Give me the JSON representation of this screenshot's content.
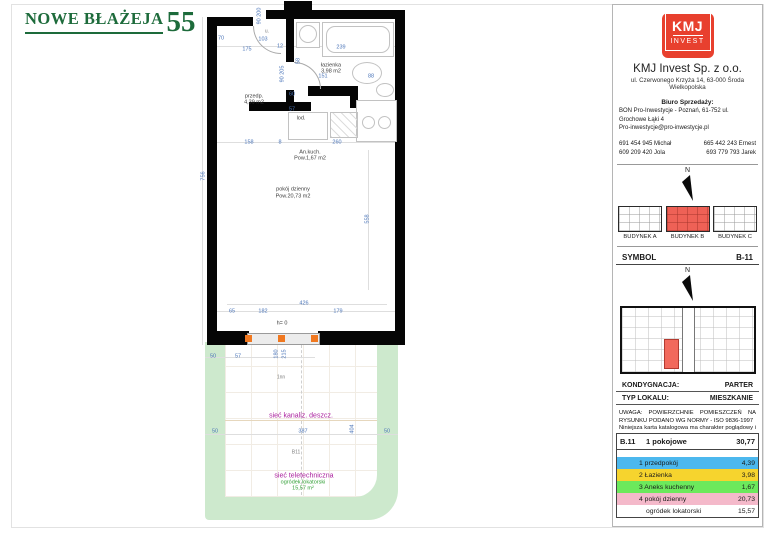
{
  "brand": {
    "title_main": "NOWE BŁAŻEJA",
    "title_number": "55"
  },
  "colors": {
    "brand_green": "#1d6b3b",
    "logo_red": "#e8402e",
    "building_highlight": "#ee6156",
    "unit_highlight": "#f2695c",
    "garden_green": "#cde9cd",
    "dim_blue": "#4a74b8",
    "utility_magenta": "#aa1f9e",
    "garden_label_green": "#2f9e33",
    "window_marker_orange": "#f07820"
  },
  "plan": {
    "labels": [
      {
        "t": "90 200",
        "x": 260,
        "y": 16,
        "r": 1
      },
      {
        "t": "u.",
        "x": 267,
        "y": 32,
        "c": "tiny"
      },
      {
        "t": "70",
        "x": 221,
        "y": 39
      },
      {
        "t": "103",
        "x": 263,
        "y": 40
      },
      {
        "t": "12",
        "x": 280,
        "y": 47
      },
      {
        "t": "175",
        "x": 247,
        "y": 50
      },
      {
        "t": "239",
        "x": 341,
        "y": 48
      },
      {
        "t": "58",
        "x": 299,
        "y": 61,
        "r": 1
      },
      {
        "t": "łazienka",
        "x": 331,
        "y": 66,
        "c": "room"
      },
      {
        "t": "3,98 m2",
        "x": 331,
        "y": 72,
        "c": "room"
      },
      {
        "t": "90 205",
        "x": 283,
        "y": 74,
        "r": 1
      },
      {
        "t": "151",
        "x": 323,
        "y": 77
      },
      {
        "t": "88",
        "x": 371,
        "y": 77
      },
      {
        "t": "60",
        "x": 292,
        "y": 95
      },
      {
        "t": "57",
        "x": 292,
        "y": 110
      },
      {
        "t": "przedp.",
        "x": 254,
        "y": 97,
        "c": "room"
      },
      {
        "t": "4,39 m2",
        "x": 254,
        "y": 103,
        "c": "room"
      },
      {
        "t": "lod.",
        "x": 301,
        "y": 119,
        "c": "room"
      },
      {
        "t": "158",
        "x": 249,
        "y": 143
      },
      {
        "t": "8",
        "x": 280,
        "y": 143
      },
      {
        "t": "260",
        "x": 337,
        "y": 143
      },
      {
        "t": "An.kuch.",
        "x": 310,
        "y": 153,
        "c": "room"
      },
      {
        "t": "Pow.1,67 m2",
        "x": 310,
        "y": 159,
        "c": "room"
      },
      {
        "t": "756",
        "x": 204,
        "y": 176,
        "r": 1
      },
      {
        "t": "pokój dzienny",
        "x": 293,
        "y": 190,
        "c": "room"
      },
      {
        "t": "Pow.20,73 m2",
        "x": 293,
        "y": 197,
        "c": "room"
      },
      {
        "t": "558",
        "x": 368,
        "y": 219,
        "r": 1
      },
      {
        "t": "426",
        "x": 304,
        "y": 304
      },
      {
        "t": "65",
        "x": 232,
        "y": 312
      },
      {
        "t": "182",
        "x": 263,
        "y": 312
      },
      {
        "t": "179",
        "x": 338,
        "y": 312
      },
      {
        "t": "h= 0",
        "x": 282,
        "y": 324,
        "c": "room"
      },
      {
        "t": "180",
        "x": 277,
        "y": 354,
        "r": 1
      },
      {
        "t": "215",
        "x": 285,
        "y": 354,
        "r": 1
      },
      {
        "t": "50",
        "x": 213,
        "y": 357
      },
      {
        "t": "57",
        "x": 238,
        "y": 357
      },
      {
        "t": "1nn",
        "x": 281,
        "y": 378,
        "c": "tiny"
      },
      {
        "t": "sieć kanaliz. deszcz.",
        "x": 301,
        "y": 416,
        "c": "mag"
      },
      {
        "t": "387",
        "x": 303,
        "y": 432
      },
      {
        "t": "404",
        "x": 353,
        "y": 429,
        "r": 1
      },
      {
        "t": "50",
        "x": 215,
        "y": 432
      },
      {
        "t": "50",
        "x": 387,
        "y": 432
      },
      {
        "t": "B11",
        "x": 296,
        "y": 453,
        "c": "tiny"
      },
      {
        "t": "sieć teletechniczna",
        "x": 304,
        "y": 476,
        "c": "mag"
      },
      {
        "t": "ogródek lokatorski",
        "x": 303,
        "y": 483,
        "c": "grn"
      },
      {
        "t": "15,57 m²",
        "x": 303,
        "y": 489,
        "c": "grn"
      }
    ]
  },
  "panel": {
    "logo": {
      "line1": "KMJ",
      "line2": "INVEST"
    },
    "company": "KMJ Invest Sp. z o.o.",
    "address": "ul. Czerwonego Krzyża 14, 63-000 Środa Wielkopolska",
    "office_label": "Biuro Sprzedaży:",
    "office_line1": "BON Pro-Inwestycje - Poznań, 61-752 ul. Grochowe Łąki 4",
    "office_line2": "Pro-inwestycje@pro-inwestycje.pl",
    "phones": [
      {
        "l": "691 454 945 Michał",
        "r": "665 442 243 Ernest"
      },
      {
        "l": "609 209 420 Jola",
        "r": "693 779 793 Jarek"
      }
    ],
    "compass_label": "N",
    "buildings": [
      "BUDYNEK A",
      "BUDYNEK B",
      "BUDYNEK C"
    ],
    "symbol_label": "SYMBOL",
    "symbol_value": "B-11",
    "kondygnacja_label": "KONDYGNACJA:",
    "kondygnacja_value": "PARTER",
    "typ_label": "TYP LOKALU:",
    "typ_value": "MIESZKANIE",
    "disclaimer1": "UWAGA: POWIERZCHNIE POMIESZCZEŃ NA RYSUNKU PODANO WG NORMY - ISO 9836-1997",
    "disclaimer2": "Niniejsza karta katalogowa ma charakter poglądowy i nie stanowi oferty w rozumieniu przepisów Kodeksu Cywilnego"
  },
  "table": {
    "unit": "B.11",
    "type": "1 pokojowe",
    "total": "30,77",
    "rows": [
      {
        "label": "1 przedpokój",
        "value": "4,39",
        "color": "#4cb8ee"
      },
      {
        "label": "2 Łazienka",
        "value": "3,98",
        "color": "#f6d42e"
      },
      {
        "label": "3 Aneks kuchenny",
        "value": "1,67",
        "color": "#6ce95c"
      },
      {
        "label": "4 pokój dzienny",
        "value": "20,73",
        "color": "#f4b9ca"
      },
      {
        "label": "ogródek lokatorski",
        "value": "15,57",
        "color": "#ffffff"
      }
    ]
  }
}
